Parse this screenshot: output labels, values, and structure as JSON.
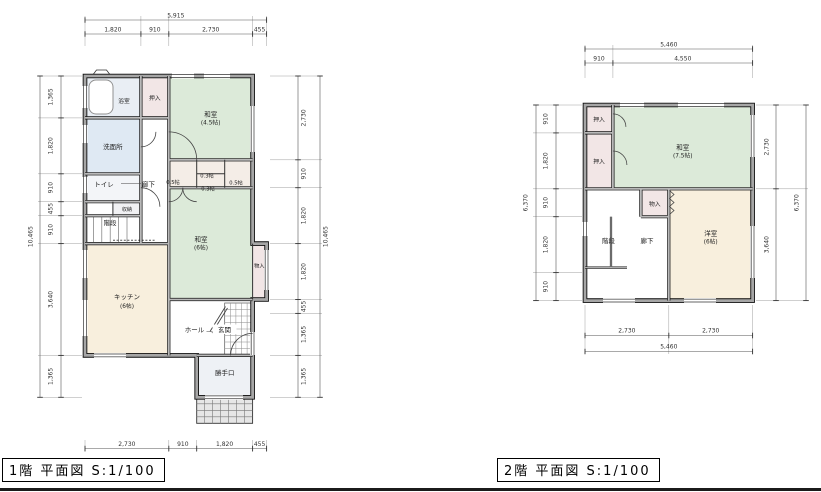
{
  "f1": {
    "title": "1階 平面図 S:1/100",
    "dims": {
      "total_w": "5,915",
      "top": [
        "1,820",
        "910",
        "2,730",
        "455"
      ],
      "bottom": [
        "2,730",
        "910",
        "1,820",
        "455"
      ],
      "total_h": "10,465",
      "left": [
        "1,365",
        "1,820",
        "910",
        "455",
        "910",
        "3,640",
        "1,365"
      ],
      "right": [
        "2,730",
        "910",
        "1,820",
        "1,820",
        "455",
        "1,365",
        "1,365"
      ]
    },
    "rooms": {
      "bath": "浴室",
      "oshiire": "押入",
      "washitsu45": {
        "name": "和室",
        "size": "(4.5帖)"
      },
      "senmenjo": "洗面所",
      "toilet": "トイレ",
      "rouka": "廊下",
      "closet_a": "0.5帖",
      "closet_b": "0.3帖",
      "closet_c": "0.3帖",
      "closet_d": "0.5帖",
      "shunou": "収納",
      "kaidan": "階段",
      "washitsu6": {
        "name": "和室",
        "size": "(6帖)"
      },
      "kitchen": {
        "name": "キッチン",
        "size": "(6帖)"
      },
      "monoire": "物入",
      "hall": "ホール",
      "genkan": "玄関",
      "katteguchi": "勝手口"
    }
  },
  "f2": {
    "title": "2階 平面図 S:1/100",
    "dims": {
      "total_w": "5,460",
      "top": [
        "910",
        "4,550"
      ],
      "bottom": [
        "2,730",
        "2,730"
      ],
      "total_h": "6,370",
      "left": [
        "910",
        "1,820",
        "910",
        "1,820",
        "910"
      ],
      "right": [
        "2,730",
        "3,640"
      ]
    },
    "rooms": {
      "oshiire_a": "押入",
      "oshiire_b": "押入",
      "washitsu75": {
        "name": "和室",
        "size": "(7.5帖)"
      },
      "monoire": "物入",
      "youshitsu": {
        "name": "洋室",
        "size": "(6帖)"
      },
      "kaidan": "階段",
      "rouka": "廊下"
    }
  }
}
